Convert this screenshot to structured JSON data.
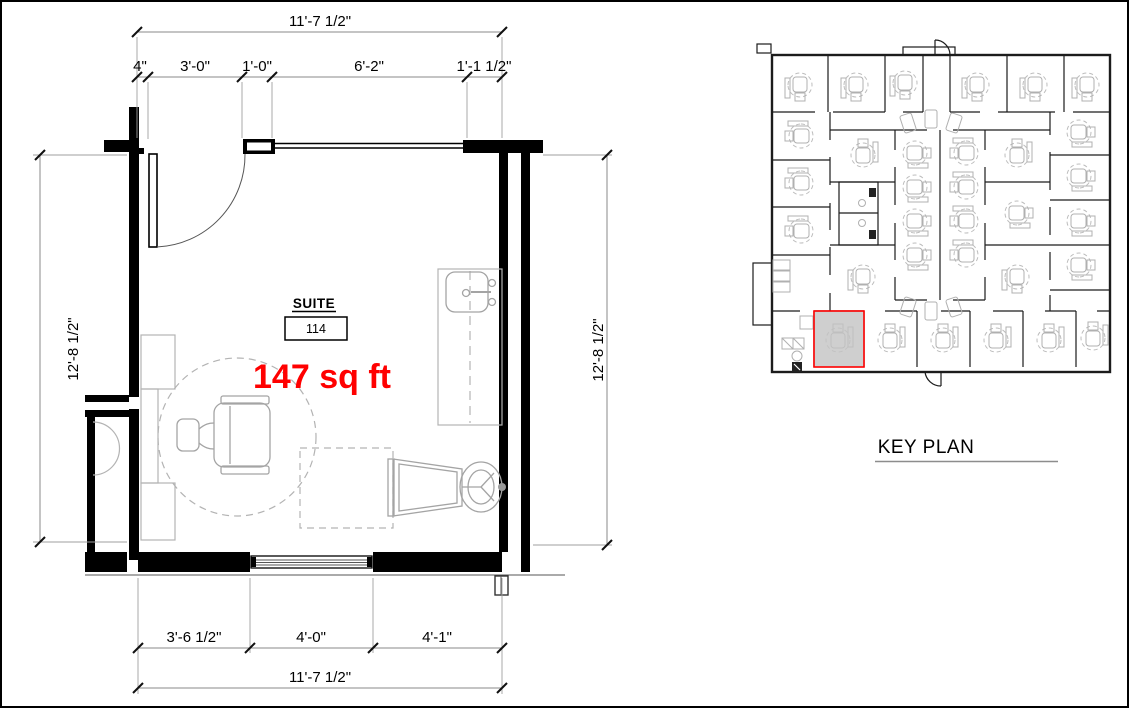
{
  "colors": {
    "accent_red": "#FF0000",
    "wall_black": "#000000",
    "furniture_gray": "#B3B3B3",
    "dim_gray": "#8A8A8A",
    "highlight_fill": "#C3C3C3"
  },
  "floor_plan": {
    "suite_label": "SUITE",
    "suite_number": "114",
    "area_label": "147 sq ft",
    "dimensions": {
      "top_overall": "11'-7 1/2\"",
      "top_segments": [
        "4\"",
        "3'-0\"",
        "1'-0\"",
        "6'-2\"",
        "1'-1 1/2\""
      ],
      "left_height": "12'-8 1/2\"",
      "right_height": "12'-8 1/2\"",
      "bottom_segments": [
        "3'-6 1/2\"",
        "4'-0\"",
        "4'-1\""
      ],
      "bottom_overall": "11'-7 1/2\""
    }
  },
  "key_plan": {
    "title": "KEY PLAN"
  }
}
